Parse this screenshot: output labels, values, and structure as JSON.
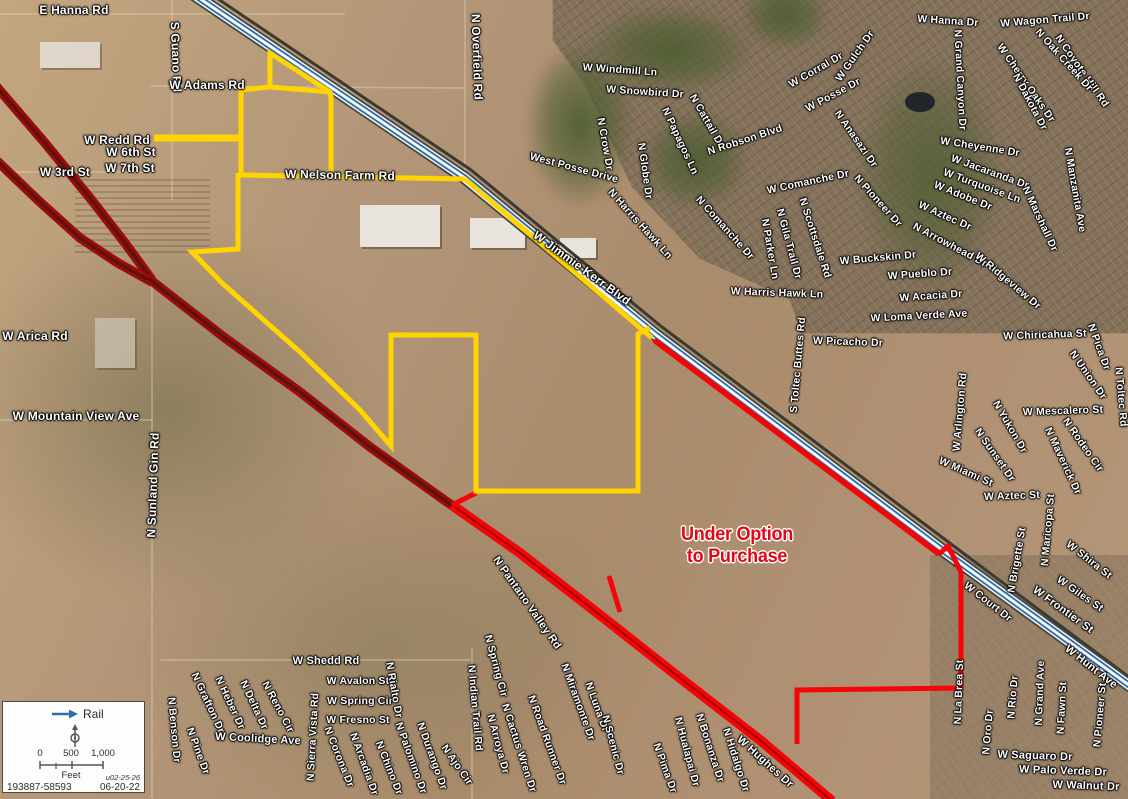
{
  "map": {
    "annotation": {
      "line1": "Under Option",
      "line2": "to Purchase",
      "x": 737,
      "y": 546,
      "color": "#e30616"
    },
    "labels": [
      {
        "t": "E Hanna Rd",
        "x": 74,
        "y": 10,
        "r": 0,
        "s": 12
      },
      {
        "t": "S Guano Rd",
        "x": 176,
        "y": 57,
        "r": 88,
        "s": 12
      },
      {
        "t": "W Adams Rd",
        "x": 207,
        "y": 85,
        "r": 0,
        "s": 12
      },
      {
        "t": "W Redd Rd",
        "x": 117,
        "y": 140,
        "r": 0,
        "s": 12
      },
      {
        "t": "W 6th St",
        "x": 131,
        "y": 152,
        "r": 0,
        "s": 12
      },
      {
        "t": "W 3rd St",
        "x": 65,
        "y": 172,
        "r": 0,
        "s": 12
      },
      {
        "t": "W 7th St",
        "x": 130,
        "y": 168,
        "r": 0,
        "s": 12
      },
      {
        "t": "W Nelson Farm Rd",
        "x": 340,
        "y": 175,
        "r": 1,
        "s": 12
      },
      {
        "t": "N Overfield Rd",
        "x": 477,
        "y": 57,
        "r": 88,
        "s": 12
      },
      {
        "t": "W Windmill Ln",
        "x": 620,
        "y": 70,
        "r": 4
      },
      {
        "t": "W Snowbird Dr",
        "x": 645,
        "y": 92,
        "r": 4
      },
      {
        "t": "West Posse Drive",
        "x": 574,
        "y": 168,
        "r": 15
      },
      {
        "t": "N Crow Dr",
        "x": 605,
        "y": 144,
        "r": 80
      },
      {
        "t": "N Globe Dr",
        "x": 645,
        "y": 171,
        "r": 82
      },
      {
        "t": "N Papagos Ln",
        "x": 680,
        "y": 141,
        "r": 65
      },
      {
        "t": "N Cattail Dr",
        "x": 707,
        "y": 121,
        "r": 60
      },
      {
        "t": "N Robson Blvd",
        "x": 745,
        "y": 140,
        "r": -18
      },
      {
        "t": "W Corral Dr",
        "x": 816,
        "y": 70,
        "r": -30
      },
      {
        "t": "W Gulch Dr",
        "x": 855,
        "y": 56,
        "r": -55
      },
      {
        "t": "W Posse Dr",
        "x": 833,
        "y": 95,
        "r": -28
      },
      {
        "t": "N Anasazi Dr",
        "x": 856,
        "y": 139,
        "r": 55
      },
      {
        "t": "W Hanna Dr",
        "x": 948,
        "y": 21,
        "r": 4
      },
      {
        "t": "W Wagon Trail Dr",
        "x": 1045,
        "y": 20,
        "r": -5
      },
      {
        "t": "N Coyote Hill Rd",
        "x": 1082,
        "y": 71,
        "r": 55
      },
      {
        "t": "N Oak Creek Dr",
        "x": 1064,
        "y": 60,
        "r": 48
      },
      {
        "t": "W Cherry Oaks Dr",
        "x": 1026,
        "y": 83,
        "r": 55
      },
      {
        "t": "N Dakota Dr",
        "x": 1030,
        "y": 102,
        "r": 62
      },
      {
        "t": "N Grand Canyon Dr",
        "x": 960,
        "y": 80,
        "r": 87
      },
      {
        "t": "W Cheyenne Dr",
        "x": 980,
        "y": 147,
        "r": 9
      },
      {
        "t": "W Jacaranda Dr",
        "x": 990,
        "y": 172,
        "r": 20
      },
      {
        "t": "W Turquoise Ln",
        "x": 982,
        "y": 186,
        "r": 20
      },
      {
        "t": "W Adobe Dr",
        "x": 963,
        "y": 196,
        "r": 22
      },
      {
        "t": "W Aztec Dr",
        "x": 945,
        "y": 216,
        "r": 24
      },
      {
        "t": "N Arrowhead Dr",
        "x": 950,
        "y": 245,
        "r": 28
      },
      {
        "t": "N Pioneer Dr",
        "x": 878,
        "y": 201,
        "r": 48
      },
      {
        "t": "W Comanche Dr",
        "x": 808,
        "y": 182,
        "r": -12
      },
      {
        "t": "N Comanche Dr",
        "x": 725,
        "y": 228,
        "r": 48
      },
      {
        "t": "N Harris Hawk Ln",
        "x": 640,
        "y": 224,
        "r": 48
      },
      {
        "t": "W Harris Hawk Ln",
        "x": 777,
        "y": 293,
        "r": 2
      },
      {
        "t": "N Parker Ln",
        "x": 770,
        "y": 249,
        "r": 80
      },
      {
        "t": "N Gila Trail Dr",
        "x": 789,
        "y": 244,
        "r": 75
      },
      {
        "t": "N Scottsdale Rd",
        "x": 815,
        "y": 238,
        "r": 72
      },
      {
        "t": "W Buckskin Dr",
        "x": 878,
        "y": 258,
        "r": -5
      },
      {
        "t": "W Pueblo Dr",
        "x": 920,
        "y": 274,
        "r": -4
      },
      {
        "t": "W Acacia Dr",
        "x": 931,
        "y": 296,
        "r": -4
      },
      {
        "t": "W Loma Verde Ave",
        "x": 919,
        "y": 316,
        "r": -3
      },
      {
        "t": "N Marshall Dr",
        "x": 1040,
        "y": 219,
        "r": 65
      },
      {
        "t": "N Manzanita Ave",
        "x": 1075,
        "y": 190,
        "r": 80
      },
      {
        "t": "W Ridgeview Dr",
        "x": 1008,
        "y": 281,
        "r": 40
      },
      {
        "t": "W Jimmie Kerr Blvd",
        "x": 582,
        "y": 268,
        "r": 36,
        "s": 12
      },
      {
        "t": "S Toltec Buttes Rd",
        "x": 798,
        "y": 365,
        "r": -85
      },
      {
        "t": "W Picacho Dr",
        "x": 848,
        "y": 342,
        "r": 2
      },
      {
        "t": "W Chiricahua St",
        "x": 1045,
        "y": 335,
        "r": -2
      },
      {
        "t": "N Pica Dr",
        "x": 1099,
        "y": 347,
        "r": 70
      },
      {
        "t": "N Union Dr",
        "x": 1088,
        "y": 375,
        "r": 55
      },
      {
        "t": "N Toltec Rd",
        "x": 1121,
        "y": 397,
        "r": 85
      },
      {
        "t": "W Arica Rd",
        "x": 35,
        "y": 336,
        "r": 0,
        "s": 12
      },
      {
        "t": "W Mountain View Ave",
        "x": 76,
        "y": 416,
        "r": 0,
        "s": 12
      },
      {
        "t": "N Sunland Gin Rd",
        "x": 153,
        "y": 485,
        "r": -88,
        "s": 12
      },
      {
        "t": "W Arlington Rd",
        "x": 960,
        "y": 412,
        "r": -85
      },
      {
        "t": "W Mescalero St",
        "x": 1063,
        "y": 411,
        "r": -2
      },
      {
        "t": "N Yukon Dr",
        "x": 1010,
        "y": 427,
        "r": 60
      },
      {
        "t": "N Sunset Dr",
        "x": 995,
        "y": 455,
        "r": 55
      },
      {
        "t": "N Rodeo Cir",
        "x": 1083,
        "y": 445,
        "r": 55
      },
      {
        "t": "N Maverick Dr",
        "x": 1063,
        "y": 461,
        "r": 65
      },
      {
        "t": "W Miami St",
        "x": 966,
        "y": 472,
        "r": 24
      },
      {
        "t": "W Aztec St",
        "x": 1012,
        "y": 496,
        "r": -2
      },
      {
        "t": "N Maricopa St",
        "x": 1048,
        "y": 530,
        "r": -85
      },
      {
        "t": "W Shira St",
        "x": 1089,
        "y": 560,
        "r": 38
      },
      {
        "t": "N Brigette St",
        "x": 1017,
        "y": 560,
        "r": -80
      },
      {
        "t": "W Giles St",
        "x": 1080,
        "y": 594,
        "r": 35
      },
      {
        "t": "W Frontier St",
        "x": 1063,
        "y": 610,
        "r": 36,
        "s": 11
      },
      {
        "t": "W Court Dr",
        "x": 988,
        "y": 602,
        "r": 38
      },
      {
        "t": "W Hunt Ave",
        "x": 1091,
        "y": 667,
        "r": 38,
        "s": 11
      },
      {
        "t": "N Pantano Valley Rd",
        "x": 527,
        "y": 603,
        "r": 55,
        "s": 11
      },
      {
        "t": "W Shedd Rd",
        "x": 326,
        "y": 661,
        "r": 0,
        "s": 11
      },
      {
        "t": "W Avalon St",
        "x": 358,
        "y": 681,
        "r": 0
      },
      {
        "t": "W Spring Cir",
        "x": 360,
        "y": 701,
        "r": 0
      },
      {
        "t": "W Fresno St",
        "x": 358,
        "y": 720,
        "r": 0
      },
      {
        "t": "N Rialto Dr",
        "x": 394,
        "y": 690,
        "r": 80
      },
      {
        "t": "N Indian Trail Rd",
        "x": 475,
        "y": 708,
        "r": 85
      },
      {
        "t": "N Spring Cir",
        "x": 496,
        "y": 666,
        "r": 75
      },
      {
        "t": "N Arroya Dr",
        "x": 498,
        "y": 744,
        "r": 75
      },
      {
        "t": "N Cactus Wren Dr",
        "x": 519,
        "y": 748,
        "r": 72
      },
      {
        "t": "N Road Runner Dr",
        "x": 547,
        "y": 740,
        "r": 70
      },
      {
        "t": "N Miramonte Dr",
        "x": 578,
        "y": 702,
        "r": 70
      },
      {
        "t": "N Luna Dr",
        "x": 597,
        "y": 707,
        "r": 70
      },
      {
        "t": "N Scenic Dr",
        "x": 613,
        "y": 745,
        "r": 75
      },
      {
        "t": "N Pima Dr",
        "x": 665,
        "y": 768,
        "r": 70
      },
      {
        "t": "N Hualapai Dr",
        "x": 687,
        "y": 752,
        "r": 75
      },
      {
        "t": "N Bonanza Dr",
        "x": 710,
        "y": 748,
        "r": 72
      },
      {
        "t": "N Hidalgo Dr",
        "x": 736,
        "y": 760,
        "r": 72
      },
      {
        "t": "W Hughes Dr",
        "x": 765,
        "y": 762,
        "r": 42,
        "s": 11
      },
      {
        "t": "N Benson Dr",
        "x": 174,
        "y": 730,
        "r": 85
      },
      {
        "t": "N Grafton Dr",
        "x": 208,
        "y": 703,
        "r": 65
      },
      {
        "t": "N Heber Dr",
        "x": 230,
        "y": 703,
        "r": 65
      },
      {
        "t": "N Delta Dr",
        "x": 254,
        "y": 705,
        "r": 65
      },
      {
        "t": "N Reno Cir",
        "x": 278,
        "y": 707,
        "r": 62
      },
      {
        "t": "N Pine Dr",
        "x": 198,
        "y": 751,
        "r": 70
      },
      {
        "t": "W Coolidge Ave",
        "x": 258,
        "y": 739,
        "r": 3,
        "s": 11
      },
      {
        "t": "N Sierra Vista Rd",
        "x": 313,
        "y": 737,
        "r": -87
      },
      {
        "t": "N Corona Dr",
        "x": 339,
        "y": 757,
        "r": 68
      },
      {
        "t": "N Arcadia Dr",
        "x": 364,
        "y": 764,
        "r": 70
      },
      {
        "t": "N Chino Dr",
        "x": 389,
        "y": 768,
        "r": 68
      },
      {
        "t": "N Palomino Dr",
        "x": 411,
        "y": 758,
        "r": 70
      },
      {
        "t": "N Durango Dr",
        "x": 432,
        "y": 756,
        "r": 70
      },
      {
        "t": "N Ajo Cir",
        "x": 457,
        "y": 765,
        "r": 55
      },
      {
        "t": "N La Brea St",
        "x": 959,
        "y": 692,
        "r": -88
      },
      {
        "t": "N Oro Dr",
        "x": 988,
        "y": 732,
        "r": -85
      },
      {
        "t": "N Rio Dr",
        "x": 1013,
        "y": 697,
        "r": -85
      },
      {
        "t": "N Grand Ave",
        "x": 1040,
        "y": 693,
        "r": -88
      },
      {
        "t": "N Fawn St",
        "x": 1062,
        "y": 708,
        "r": -87
      },
      {
        "t": "N Pioneer St",
        "x": 1100,
        "y": 715,
        "r": -85
      },
      {
        "t": "W Saguaro Dr",
        "x": 1035,
        "y": 756,
        "r": 2,
        "s": 11
      },
      {
        "t": "W Palo Verde Dr",
        "x": 1063,
        "y": 771,
        "r": 2,
        "s": 11
      },
      {
        "t": "W Walnut Dr",
        "x": 1086,
        "y": 786,
        "r": 2,
        "s": 11
      }
    ]
  },
  "legend": {
    "rail_label": "Rail",
    "scale_ticks": [
      "0",
      "500",
      "1,000"
    ],
    "unit": "Feet",
    "note": "u02-25-26",
    "ref": "193887-58593",
    "date": "06-20-22"
  },
  "colors": {
    "boundary_yellow": "#ffd400",
    "boundary_red": "#f50505",
    "highway_dark": "#9e0b0b",
    "highway_inner": "#5a1310",
    "rail_blue": "#2f6fae",
    "rail_casing": "#45453c",
    "minor_road": "#ddd2ba",
    "annotation_red": "#e30616"
  },
  "geometry": {
    "rail": [
      [
        193,
        -6
      ],
      [
        465,
        178
      ],
      [
        656,
        335
      ],
      [
        941,
        549
      ],
      [
        1133,
        688
      ]
    ],
    "rail_dark": [
      [
        199,
        -14
      ],
      [
        471,
        170
      ],
      [
        662,
        327
      ],
      [
        947,
        541
      ],
      [
        1133,
        680
      ]
    ],
    "highway_main": [
      [
        148,
        278
      ],
      [
        225,
        338
      ],
      [
        300,
        392
      ],
      [
        370,
        447
      ],
      [
        440,
        497
      ],
      [
        520,
        553
      ],
      [
        600,
        615
      ],
      [
        680,
        678
      ],
      [
        760,
        740
      ],
      [
        832,
        801
      ]
    ],
    "highway_wb": [
      [
        -4,
        86
      ],
      [
        45,
        143
      ],
      [
        90,
        198
      ],
      [
        125,
        243
      ],
      [
        152,
        280
      ]
    ],
    "highway_eb": [
      [
        -4,
        160
      ],
      [
        40,
        202
      ],
      [
        80,
        238
      ],
      [
        118,
        263
      ],
      [
        152,
        282
      ]
    ],
    "yellow_main": [
      [
        238,
        173
      ],
      [
        238,
        249
      ],
      [
        192,
        252
      ],
      [
        222,
        283
      ],
      [
        300,
        352
      ],
      [
        360,
        410
      ],
      [
        391,
        446
      ],
      [
        391,
        335
      ],
      [
        476,
        335
      ],
      [
        476,
        491
      ],
      [
        638,
        491
      ],
      [
        638,
        334
      ],
      [
        650,
        328
      ]
    ],
    "yellow_upper": [
      [
        241,
        173
      ],
      [
        241,
        90
      ],
      [
        270,
        87
      ],
      [
        270,
        53
      ],
      [
        330,
        92
      ],
      [
        331,
        97
      ],
      [
        331,
        173
      ]
    ],
    "yellow_tophz": [
      [
        270,
        87
      ],
      [
        330,
        92
      ]
    ],
    "yellow_notch": [
      [
        154,
        138
      ],
      [
        241,
        138
      ]
    ],
    "yellow_nelson": [
      [
        238,
        175
      ],
      [
        465,
        179
      ]
    ],
    "yellow_railpar": [
      [
        465,
        179
      ],
      [
        652,
        338
      ]
    ],
    "red_railpar": [
      [
        654,
        340
      ],
      [
        939,
        554
      ]
    ],
    "red_zig": [
      [
        939,
        554
      ],
      [
        948,
        546
      ],
      [
        961,
        572
      ],
      [
        961,
        688
      ],
      [
        797,
        690
      ],
      [
        797,
        744
      ]
    ],
    "red_spur": [
      [
        609,
        576
      ],
      [
        620,
        612
      ]
    ],
    "red_connect": [
      [
        452,
        505
      ],
      [
        476,
        493
      ]
    ],
    "red_highway": [
      [
        452,
        505
      ],
      [
        520,
        553
      ],
      [
        600,
        615
      ],
      [
        680,
        678
      ],
      [
        760,
        740
      ],
      [
        832,
        801
      ]
    ],
    "minor_roads": [
      [
        [
          0,
          14
        ],
        [
          345,
          14
        ]
      ],
      [
        [
          172,
          0
        ],
        [
          172,
          200
        ]
      ],
      [
        [
          465,
          0
        ],
        [
          465,
          178
        ]
      ],
      [
        [
          152,
          278
        ],
        [
          152,
          799
        ]
      ],
      [
        [
          0,
          420
        ],
        [
          152,
          420
        ]
      ],
      [
        [
          0,
          172
        ],
        [
          150,
          172
        ]
      ],
      [
        [
          160,
          660
        ],
        [
          470,
          660
        ]
      ],
      [
        [
          472,
          648
        ],
        [
          472,
          799
        ]
      ],
      [
        [
          150,
          86
        ],
        [
          465,
          88
        ]
      ]
    ]
  }
}
